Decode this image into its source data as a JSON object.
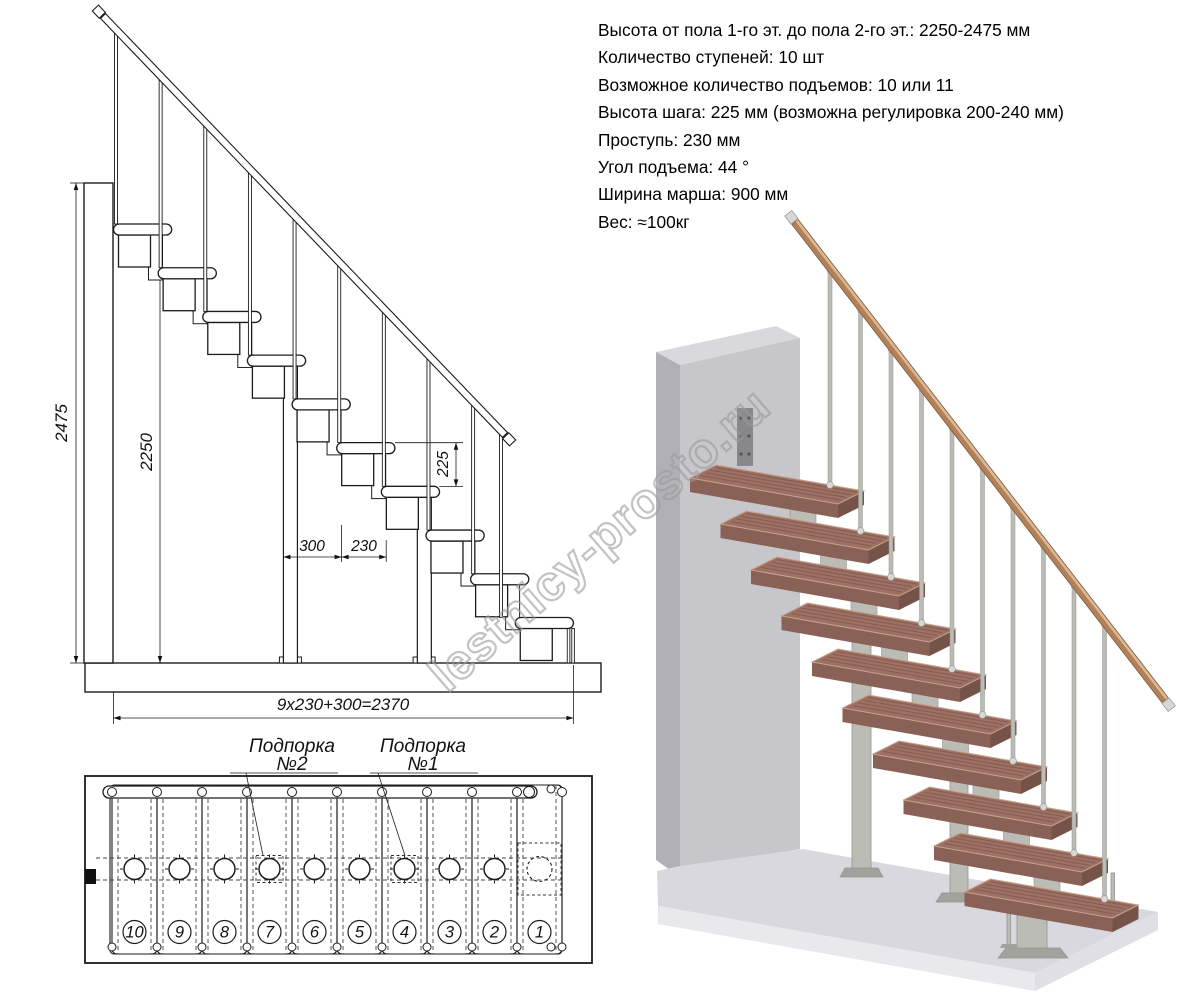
{
  "spec": {
    "lines": [
      "Высота от пола 1-го эт. до пола 2-го эт.: 2250-2475 мм",
      "Количество ступеней: 10 шт",
      "Возможное количество подъемов: 10 или 11",
      "Высота шага: 225 мм (возможна регулировка 200-240 мм)",
      "Проступь: 230 мм",
      "Угол подъема: 44 °",
      "Ширина марша: 900 мм",
      "Вес: ≈100кг"
    ]
  },
  "side_view": {
    "steps": 10,
    "labels": {
      "height_total": "2475",
      "height_steps": "2250",
      "rise": "225",
      "depth": "300",
      "run": "230",
      "total": "9x230+300=2370"
    }
  },
  "plan_view": {
    "labels": {
      "support2_line1": "Подпорка",
      "support2_line2": "№2",
      "support1_line1": "Подпорка",
      "support1_line2": "№1"
    },
    "step_numbers": [
      "10",
      "9",
      "8",
      "7",
      "6",
      "5",
      "4",
      "3",
      "2",
      "1"
    ],
    "support_steps": [
      7,
      4
    ]
  },
  "watermark": {
    "text": "lestnicy-prosto.ru"
  },
  "render3d": {
    "steps": 10,
    "colors": {
      "wall_front": "#c6c6cb",
      "wall_side": "#b0b0b6",
      "wall_top": "#d9d9dd",
      "floor_top": "#d8d8de",
      "floor_front": "#e9e9ed",
      "floor_front2": "#dfdfe5",
      "wood_top": "#9c7164",
      "wood_front": "#8a6156",
      "wood_side": "#765349",
      "wood_grain": "rgba(80,42,34,0.30)",
      "wood_light": "#c9a28c",
      "metal": "#bcbcb7",
      "metal_dark": "#93938e",
      "flange": "#a2a29d",
      "rail": "#b28159",
      "rail_edge": "#7d5a3c",
      "rail_light": "rgba(255,231,200,0.55)",
      "cap": "#d7d7d3",
      "bracket": "#87878c"
    }
  }
}
